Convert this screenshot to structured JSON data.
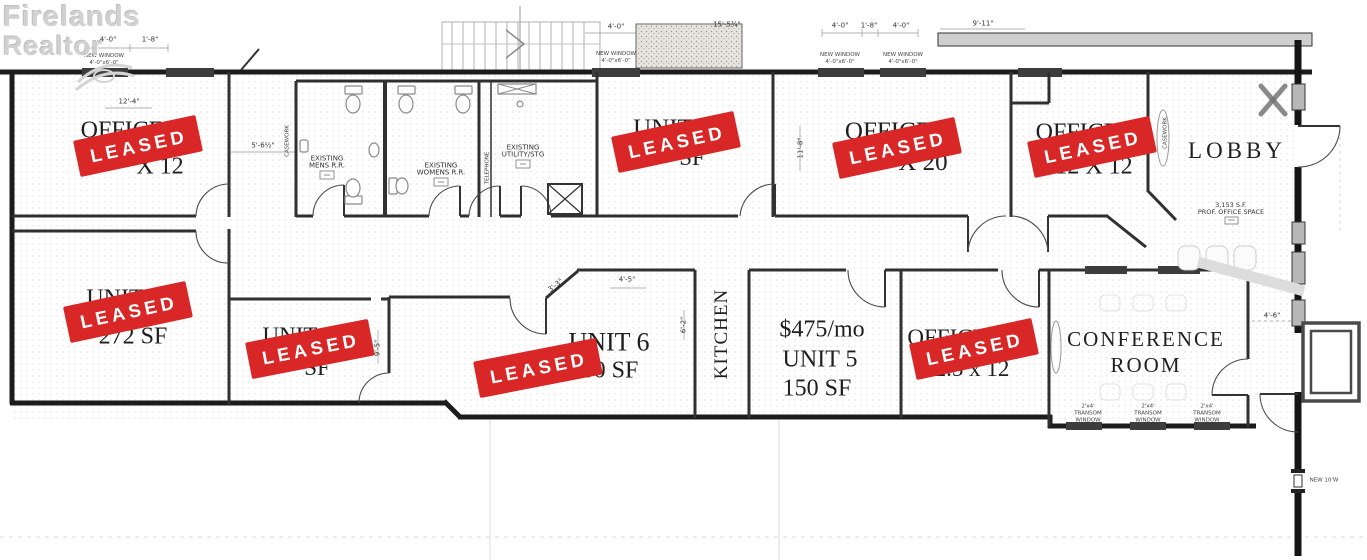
{
  "watermark": {
    "line1": "Firelands",
    "line2": "Realtor"
  },
  "stamp": {
    "label": "LEASED",
    "color": "#d92727",
    "count": 8
  },
  "rooms": {
    "office_nw": {
      "line1": "OFFICE",
      "line2": "X 12"
    },
    "unit4": {
      "line1": "UNIT",
      "line2": "SF"
    },
    "office_20": {
      "line1": "OFFICE",
      "line2": "X 20"
    },
    "office_12": {
      "line1": "OFFICE",
      "line2": "12 X 12"
    },
    "lobby": {
      "label": "LOBBY"
    },
    "unit_272": {
      "line1": "UNIT",
      "line2": "272 SF"
    },
    "unit_small": {
      "line1": "UNIT",
      "line2": "SF"
    },
    "unit6": {
      "line1": "UNIT 6",
      "line2": "200 SF"
    },
    "kitchen": {
      "label": "KITCHEN"
    },
    "unit5": {
      "price": "$475/mo",
      "line1": "UNIT 5",
      "line2": "150 SF"
    },
    "office_se": {
      "line1": "OFFICE",
      "line2": "2.5 x 12"
    },
    "conference": {
      "line1": "CONFERENCE",
      "line2": "ROOM"
    },
    "mens_rr": {
      "line1": "EXISTING",
      "line2": "MENS  R.R."
    },
    "womens_rr": {
      "line1": "EXISTING",
      "line2": "WOMENS  R.R."
    },
    "utility": {
      "line1": "EXISTING",
      "line2": "UTILITY/STG"
    },
    "office_space_note": {
      "line1": "3,153  S.F.",
      "line2": "PROF.  OFFICE  SPACE"
    }
  },
  "annotations": {
    "casework": "CASEWORK",
    "telephone": "TELEPHONE",
    "transom": {
      "line1": "2'x4'",
      "line2": "TRANSOM",
      "line3": "WINDOW"
    },
    "new_window": {
      "line1": "NEW  WINDOW",
      "line2": "4'-0\"x6'-0\""
    },
    "new_door": "NEW  10'W"
  },
  "dimensions": {
    "a": "4'-0\"",
    "b": "1'-8\"",
    "c": "12'-4\"",
    "d": "5'-6½\"",
    "e": "15'-5¾\"",
    "f": "9'-11\"",
    "g": "11'-8\"",
    "h": "4'-5\"",
    "i": "3'-3\"",
    "j": "9'-5\"",
    "k": "6'-2\"",
    "l": "4'-6\""
  }
}
